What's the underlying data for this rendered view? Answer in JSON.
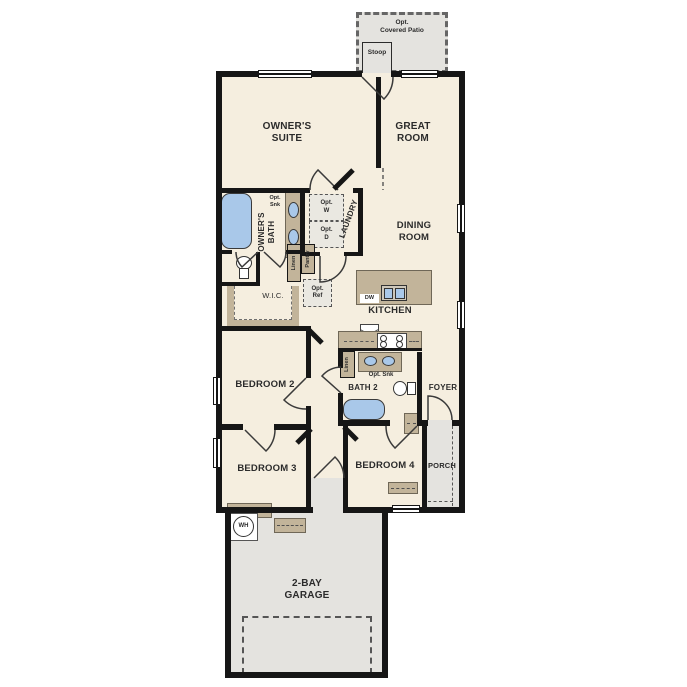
{
  "labels": {
    "covered_patio": "Opt.\nCovered Patio",
    "stoop": "Stoop",
    "owners_suite": "OWNER'S\nSUITE",
    "great_room": "GREAT\nROOM",
    "dining_room": "DINING\nROOM",
    "owners_bath": "OWNER'S\nBATH",
    "laundry": "LAUNDRY",
    "opt_washer": "Opt.\nW",
    "opt_dryer": "Opt.\nD",
    "opt_sink_owners": "Opt.\nSnk",
    "linen_hall": "Linen",
    "pantry": "Pantry",
    "opt_ref": "Opt.\nRef",
    "wic": "W.I.C.",
    "kitchen": "KITCHEN",
    "dishwasher": "DW",
    "bedroom2": "BEDROOM 2",
    "linen_kitchen": "Linen",
    "opt_sink_bath2": "Opt. Snk",
    "bath2": "BATH 2",
    "foyer": "FOYER",
    "bedroom3": "BEDROOM 3",
    "bedroom4": "BEDROOM 4",
    "porch": "PORCH",
    "garage": "2-BAY\nGARAGE",
    "water_heater": "WH"
  },
  "colors": {
    "floor": "#f5eedf",
    "wall": "#161616",
    "counter": "#c2b49a",
    "fixture_blue": "#a9c8e9",
    "outdoor": "#e4e3df",
    "text": "#2b2b2b"
  }
}
